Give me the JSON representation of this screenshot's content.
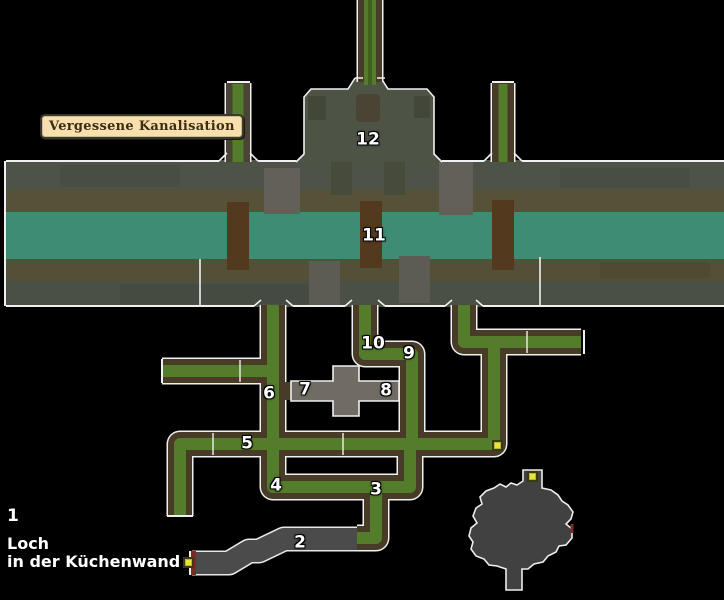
{
  "map_label": "Vergessene Kanalisation",
  "legend": {
    "number": "1",
    "line1": "Loch",
    "line2": "in der Küchenwand"
  },
  "point_labels": [
    "1",
    "2",
    "3",
    "4",
    "5",
    "6",
    "7",
    "8",
    "9",
    "10",
    "11",
    "12"
  ],
  "icons": {
    "door_marker": "yellow-square",
    "blocked_end": "red-bar"
  },
  "colors": {
    "background": "#000000",
    "water": "#3E8C74",
    "corridor_green": "#537D2A",
    "corridor_casing": "#483C28",
    "band_gray": "#4D5347",
    "band_brown": "#575138",
    "pillar_brown": "#533A1E",
    "pillar_gray": "#636157",
    "room12_gray": "#4D5446",
    "cross_room_gray": "#706C64",
    "tunnel_gray": "#4B4B4B",
    "cave_gray": "#414141",
    "outline": "#F0F0F0",
    "marker_yellow": "#E8E53A",
    "door_red": "#7A2A22",
    "label_bg": "#F7E0AE",
    "label_text": "#3C2D12"
  }
}
